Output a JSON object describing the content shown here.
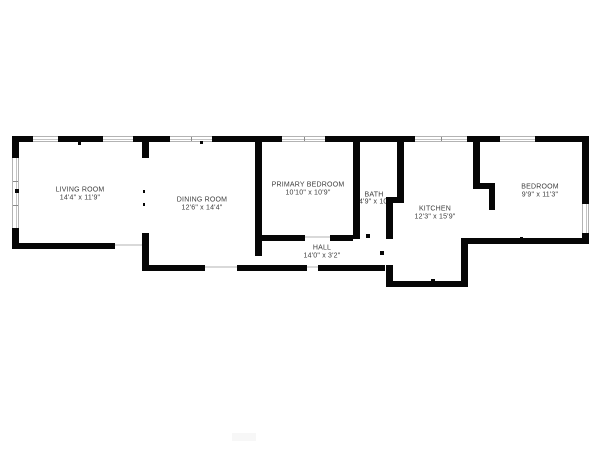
{
  "page": {
    "background": "#ffffff"
  },
  "floor_plan": {
    "colors": {
      "wall": "#060606",
      "window_line": "#b3b3b3",
      "window_divider": "#8a8a8a",
      "threshold": "#d9d9d9",
      "label_text": "#3c3c3c",
      "background": "#ffffff",
      "watermark": "#f7f7f7"
    },
    "rooms": [
      {
        "id": "living-room",
        "name": "LIVING ROOM",
        "dims": "14'4\" x 11'9\"",
        "cx": 80,
        "name_cy": 190,
        "dims_cy": 198
      },
      {
        "id": "dining-room",
        "name": "DINING ROOM",
        "dims": "12'6\" x 14'4\"",
        "cx": 202,
        "name_cy": 200,
        "dims_cy": 208
      },
      {
        "id": "primary-bedroom",
        "name": "PRIMARY BEDROOM",
        "dims": "10'10\" x 10'9\"",
        "cx": 308,
        "name_cy": 185,
        "dims_cy": 193
      },
      {
        "id": "bath",
        "name": "BATH",
        "dims": "4'9\" x 10'",
        "cx": 374,
        "name_cy": 195,
        "dims_cy": 202
      },
      {
        "id": "hall",
        "name": "HALL",
        "dims": "14'0\" x 3'2\"",
        "cx": 322,
        "name_cy": 248,
        "dims_cy": 256
      },
      {
        "id": "kitchen",
        "name": "KITCHEN",
        "dims": "12'3\" x 15'9\"",
        "cx": 435,
        "name_cy": 209,
        "dims_cy": 217
      },
      {
        "id": "bedroom",
        "name": "BEDROOM",
        "dims": "9'9\" x 11'3\"",
        "cx": 540,
        "name_cy": 187,
        "dims_cy": 195
      }
    ],
    "walls": [
      {
        "x": 12,
        "y": 136,
        "w": 21,
        "h": 6
      },
      {
        "x": 58,
        "y": 136,
        "w": 45,
        "h": 6
      },
      {
        "x": 133,
        "y": 136,
        "w": 37,
        "h": 6
      },
      {
        "x": 212,
        "y": 136,
        "w": 70,
        "h": 6
      },
      {
        "x": 325,
        "y": 136,
        "w": 90,
        "h": 6
      },
      {
        "x": 467,
        "y": 136,
        "w": 33,
        "h": 6
      },
      {
        "x": 535,
        "y": 136,
        "w": 54,
        "h": 6
      },
      {
        "x": 12,
        "y": 136,
        "w": 7,
        "h": 22
      },
      {
        "x": 12,
        "y": 228,
        "w": 7,
        "h": 21
      },
      {
        "x": 12,
        "y": 243,
        "w": 103,
        "h": 6
      },
      {
        "x": 142,
        "y": 142,
        "w": 7,
        "h": 16
      },
      {
        "x": 142,
        "y": 233,
        "w": 7,
        "h": 38
      },
      {
        "x": 142,
        "y": 265,
        "w": 63,
        "h": 6
      },
      {
        "x": 237,
        "y": 265,
        "w": 70,
        "h": 6
      },
      {
        "x": 318,
        "y": 265,
        "w": 67,
        "h": 6
      },
      {
        "x": 255,
        "y": 136,
        "w": 7,
        "h": 120
      },
      {
        "x": 255,
        "y": 235,
        "w": 50,
        "h": 6
      },
      {
        "x": 330,
        "y": 235,
        "w": 23,
        "h": 6
      },
      {
        "x": 353,
        "y": 136,
        "w": 7,
        "h": 103
      },
      {
        "x": 397,
        "y": 142,
        "w": 7,
        "h": 61
      },
      {
        "x": 386,
        "y": 197,
        "w": 18,
        "h": 6
      },
      {
        "x": 386,
        "y": 197,
        "w": 7,
        "h": 42
      },
      {
        "x": 386,
        "y": 265,
        "w": 7,
        "h": 22
      },
      {
        "x": 386,
        "y": 281,
        "w": 82,
        "h": 6
      },
      {
        "x": 461,
        "y": 238,
        "w": 7,
        "h": 49
      },
      {
        "x": 461,
        "y": 238,
        "w": 126,
        "h": 6
      },
      {
        "x": 473,
        "y": 142,
        "w": 7,
        "h": 41
      },
      {
        "x": 473,
        "y": 183,
        "w": 22,
        "h": 6
      },
      {
        "x": 489,
        "y": 189,
        "w": 6,
        "h": 21
      },
      {
        "x": 582,
        "y": 136,
        "w": 7,
        "h": 68
      },
      {
        "x": 582,
        "y": 233,
        "w": 7,
        "h": 11
      }
    ],
    "windows": [
      {
        "x": 33,
        "y": 136,
        "w": 25,
        "h": 6,
        "o": "h",
        "panes": 1
      },
      {
        "x": 103,
        "y": 136,
        "w": 30,
        "h": 6,
        "o": "h",
        "panes": 1
      },
      {
        "x": 170,
        "y": 136,
        "w": 42,
        "h": 6,
        "o": "h",
        "panes": 2
      },
      {
        "x": 282,
        "y": 136,
        "w": 43,
        "h": 6,
        "o": "h",
        "panes": 2
      },
      {
        "x": 415,
        "y": 136,
        "w": 52,
        "h": 6,
        "o": "h",
        "panes": 2
      },
      {
        "x": 500,
        "y": 136,
        "w": 35,
        "h": 6,
        "o": "h",
        "panes": 1
      },
      {
        "x": 12,
        "y": 158,
        "w": 7,
        "h": 70,
        "o": "v",
        "panes": 3
      },
      {
        "x": 582,
        "y": 204,
        "w": 7,
        "h": 29,
        "o": "v",
        "panes": 1
      }
    ],
    "thresholds": [
      {
        "x": 115,
        "y": 244,
        "w": 28,
        "h": 2
      },
      {
        "x": 205,
        "y": 266,
        "w": 32,
        "h": 2
      },
      {
        "x": 307,
        "y": 266,
        "w": 11,
        "h": 2
      },
      {
        "x": 305,
        "y": 236,
        "w": 25,
        "h": 2
      }
    ],
    "nubs": [
      {
        "x": 78,
        "y": 141,
        "w": 3,
        "h": 4
      },
      {
        "x": 200,
        "y": 141,
        "w": 3,
        "h": 3
      },
      {
        "x": 15,
        "y": 189,
        "w": 4,
        "h": 4
      },
      {
        "x": 143,
        "y": 190,
        "w": 2,
        "h": 3
      },
      {
        "x": 143,
        "y": 203,
        "w": 2,
        "h": 3
      },
      {
        "x": 366,
        "y": 234,
        "w": 4,
        "h": 4
      },
      {
        "x": 380,
        "y": 251,
        "w": 4,
        "h": 4
      },
      {
        "x": 431,
        "y": 279,
        "w": 4,
        "h": 3
      },
      {
        "x": 520,
        "y": 237,
        "w": 3,
        "h": 3
      },
      {
        "x": 538,
        "y": 239,
        "w": 3,
        "h": 3
      }
    ],
    "watermark": {
      "x": 232,
      "y": 433,
      "w": 24,
      "h": 8
    }
  }
}
